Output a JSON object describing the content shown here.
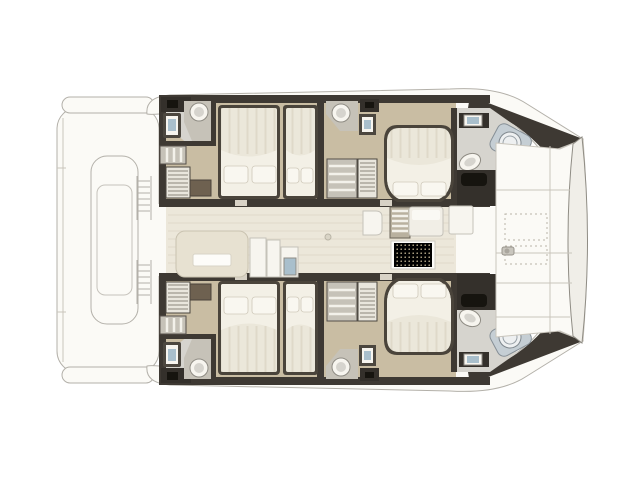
{
  "figure": {
    "type": "boat-floor-plan",
    "label": "Catamaran interior deck plan, top view, bow to the right",
    "view": "top-down",
    "orientation": "bow-right",
    "visible_text": []
  },
  "colors": {
    "outline": "#b3b0a9",
    "deck": "#fbfaf6",
    "deckshade": "#f3f1ea",
    "wall": "#3e3933",
    "charcoal": "#34302b",
    "iconblack": "#16140f",
    "wood": "#c9bda3",
    "bath": "#d6d4ce",
    "counter": "#c6c2b8",
    "fixture": "#f7f5ef",
    "fixline": "#8f8c84",
    "bedframe": "#4a443b",
    "mattress": "#ebe7da",
    "stripe": "#dcd6c5",
    "sheet": "#f3f0e6",
    "pillow": "#f9f7f0",
    "pillowline": "#cfc9ba",
    "brown": "#6e6150",
    "blue": "#a9bfcc",
    "hatch": "#c5ced4",
    "hatchline": "#868f96",
    "salon": "#ece7da",
    "salonline": "#e0dacb",
    "seam": "#c9c5bc",
    "dashline": "#b8b4a8",
    "mat": "#d8cfb5",
    "matdot": "#bfb292",
    "stairfill": "#e9e6dd",
    "stairline": "#8a867c",
    "doorgap": "#d8d2c6",
    "unitframe": "#4c473f",
    "slatline": "#f3f1ea",
    "furnline": "#c5c2b9",
    "sofafill": "#e7e1d1",
    "sofaline": "#c9c2b0",
    "band": "#f0eee8"
  },
  "features": [
    "stern swim platform with tender lift",
    "aft companionway ladder vents",
    "port aft cabin with double and single berth",
    "port aft bathroom with sink and toilet",
    "port hull wardrobe and companionway stairs",
    "port forward cabin with island double berth",
    "port forward bathroom with sinks and shower",
    "salon with sofa, galley units, table and dotted mat",
    "forward cockpit seats",
    "foredeck sun lounge with stitched cushions and windlass",
    "bow hatches on both hulls",
    "starboard aft cabin with double and single berth",
    "starboard aft bathroom with sink and toilet",
    "starboard forward cabin with island double berth",
    "starboard forward bathroom"
  ]
}
